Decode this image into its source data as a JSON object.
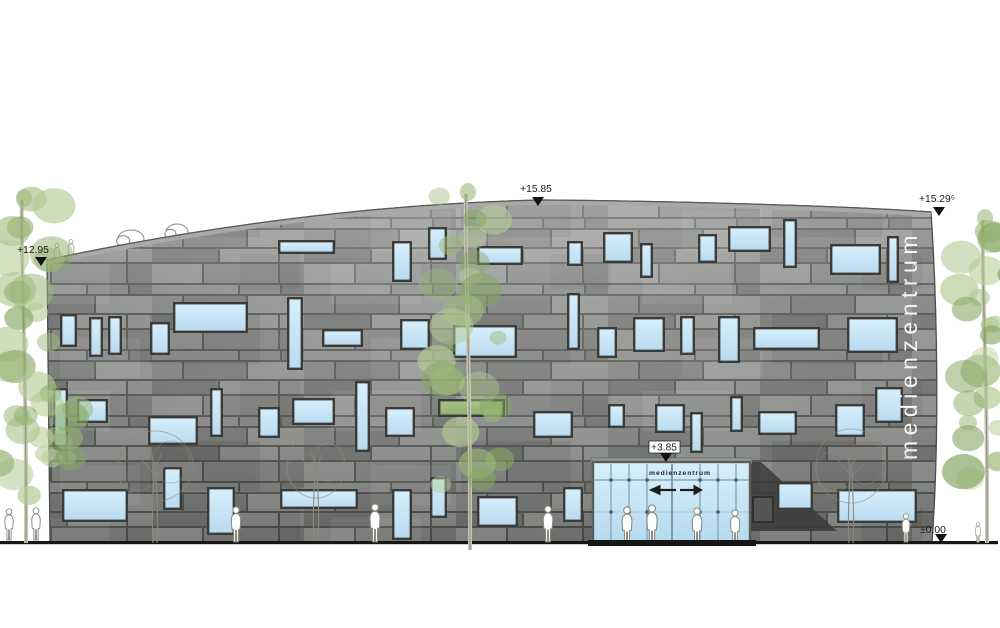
{
  "drawing": {
    "title_vertical": "medienzentrum",
    "markers": [
      {
        "label": "+15.85",
        "tx": 536,
        "ty": 192,
        "ax": 538,
        "ay": 206
      },
      {
        "label": "+15.29⁵",
        "tx": 937,
        "ty": 202,
        "ax": 939,
        "ay": 216
      },
      {
        "label": "+12.95",
        "tx": 33,
        "ty": 253,
        "ax": 41,
        "ay": 266
      },
      {
        "label": "+3.85",
        "tx": 664,
        "ty": 450.5,
        "ax": 666,
        "ay": 462,
        "box": [
          649,
          441,
          31,
          12
        ]
      },
      {
        "label": "±0.00",
        "tx": 933,
        "ty": 533,
        "ax": 941,
        "ay": 543
      }
    ],
    "entrance": {
      "x": 593,
      "y": 462,
      "w": 157,
      "h": 81,
      "sign": "medienzentrum",
      "mullions": [
        611,
        629,
        647,
        700,
        718,
        736
      ],
      "door_center": 672,
      "transom_y": 480,
      "dot_rows": [
        480,
        512
      ],
      "arrow_y": 490,
      "sign_x": 680,
      "sign_y": 475
    }
  },
  "colors": {
    "facade_joint": "#525351",
    "facade_blocks": [
      "#8d8f8d",
      "#7f817f",
      "#757775",
      "#888a88",
      "#6f716f"
    ],
    "parapet": "#a8aaa8",
    "outline": "#4c4d4b",
    "window_frame": "#3b3c3a",
    "window_blue_top": "#d6eefb",
    "window_blue_bottom": "#badcf0",
    "window_green": "#a6c186",
    "glass_top": "#d8effb",
    "glass_bottom": "#b5daee",
    "mullion": "#7b9dae",
    "dot": "#4e6473",
    "wedge": "#3a3b39",
    "ground": "#161614",
    "marker_text": "#1b1b19",
    "title_fill": "#f4f4f2",
    "tree_greens": [
      "#9cb97b",
      "#b4cb95",
      "#84a763"
    ],
    "trunk_light": "#cac7b9",
    "trunk_dark": "#8e8c7c",
    "sketch": "#888a80",
    "person_stroke": "#8b8b83"
  },
  "facade": {
    "outline": "M50,543 L47,260 C200,227 380,203 545,200 C700,201.5 852,206.5 931,212 C937.5,310 939.5,437 932,543 Z",
    "top_curve": "M47,260 C200,227 380,203 545,200 C700,201.5 852,206.5 931,212"
  },
  "windows": {
    "blue": [
      [
        278,
        240,
        57,
        14
      ],
      [
        392,
        241,
        20,
        41
      ],
      [
        428,
        227,
        19,
        33
      ],
      [
        477,
        246,
        46,
        19
      ],
      [
        567,
        241,
        16,
        25
      ],
      [
        603,
        232,
        30,
        31
      ],
      [
        640,
        243,
        13,
        35
      ],
      [
        698,
        234,
        19,
        29
      ],
      [
        728,
        226,
        43,
        26
      ],
      [
        783,
        219,
        14,
        49
      ],
      [
        830,
        244,
        51,
        31
      ],
      [
        887,
        236,
        12,
        47
      ],
      [
        60,
        314,
        17,
        33
      ],
      [
        89,
        317,
        14,
        40
      ],
      [
        108,
        316,
        14,
        39
      ],
      [
        150,
        322,
        20,
        33
      ],
      [
        173,
        302,
        75,
        31
      ],
      [
        287,
        297,
        16,
        73
      ],
      [
        322,
        329,
        41,
        18
      ],
      [
        400,
        319,
        30,
        31
      ],
      [
        453,
        325,
        64,
        33
      ],
      [
        567,
        293,
        13,
        57
      ],
      [
        597,
        327,
        20,
        31
      ],
      [
        633,
        317,
        32,
        35
      ],
      [
        680,
        316,
        15,
        39
      ],
      [
        718,
        316,
        22,
        47
      ],
      [
        753,
        327,
        67,
        23
      ],
      [
        847,
        317,
        51,
        36
      ],
      [
        53,
        388,
        15,
        59
      ],
      [
        77,
        399,
        31,
        24
      ],
      [
        148,
        416,
        50,
        29
      ],
      [
        210,
        388,
        13,
        49
      ],
      [
        258,
        407,
        22,
        31
      ],
      [
        292,
        398,
        43,
        27
      ],
      [
        355,
        381,
        15,
        71
      ],
      [
        385,
        407,
        30,
        30
      ],
      [
        533,
        411,
        40,
        27
      ],
      [
        608,
        404,
        17,
        24
      ],
      [
        655,
        404,
        30,
        29
      ],
      [
        690,
        412,
        13,
        41
      ],
      [
        730,
        396,
        13,
        36
      ],
      [
        758,
        411,
        39,
        24
      ],
      [
        835,
        404,
        30,
        33
      ],
      [
        875,
        387,
        28,
        36
      ],
      [
        62,
        489,
        66,
        33
      ],
      [
        163,
        467,
        19,
        43
      ],
      [
        207,
        487,
        28,
        48
      ],
      [
        280,
        489,
        78,
        20
      ],
      [
        392,
        489,
        20,
        51
      ],
      [
        430,
        477,
        17,
        41
      ],
      [
        477,
        496,
        41,
        31
      ],
      [
        563,
        487,
        20,
        35
      ],
      [
        777,
        482,
        36,
        28
      ],
      [
        837,
        489,
        80,
        34
      ]
    ],
    "green": [
      [
        438,
        399,
        67,
        18
      ]
    ]
  },
  "shadow_wedge": {
    "points": "750,462 761,462 837,531 750,531",
    "panel": [
      753,
      497,
      20,
      25
    ]
  },
  "ground_line": {
    "x1": 0,
    "x2": 998,
    "y": 541,
    "h": 3.2,
    "threshold": [
      588,
      540,
      168,
      6
    ]
  },
  "trees": {
    "green": [
      {
        "trunk_x": 24,
        "top": 188,
        "bottom": 543,
        "spread": 30,
        "blobs": 26,
        "seed": 7
      },
      {
        "trunk_x": 468,
        "top": 182,
        "bottom": 550,
        "spread": 33,
        "blobs": 24,
        "seed": 13
      },
      {
        "trunk_x": 985,
        "top": 208,
        "bottom": 543,
        "spread": 27,
        "blobs": 24,
        "seed": 29
      }
    ],
    "green_bush": {
      "cx": 58,
      "cy": 425,
      "spread": 20,
      "height": 80,
      "blobs": 9,
      "seed": 3
    },
    "sketch": [
      {
        "cx": 155,
        "crown_cy": 466,
        "rx": 38,
        "ry": 35,
        "ground": 543
      },
      {
        "cx": 316,
        "crown_cy": 466,
        "rx": 29,
        "ry": 32,
        "ground": 537
      },
      {
        "cx": 851,
        "crown_cy": 466,
        "rx": 35,
        "ry": 37,
        "ground": 543
      }
    ],
    "roof_bushes": [
      {
        "cx": 131,
        "cy": 239,
        "rx": 13,
        "ry": 9
      },
      {
        "cx": 177,
        "cy": 232,
        "rx": 11,
        "ry": 8
      }
    ]
  },
  "people": {
    "on_roof": [
      {
        "x": 57,
        "y": 266,
        "h": 23
      },
      {
        "x": 71,
        "y": 263,
        "h": 24
      }
    ],
    "on_ground": [
      {
        "x": 9,
        "y": 541,
        "h": 33
      },
      {
        "x": 36,
        "y": 541,
        "h": 34
      },
      {
        "x": 236,
        "y": 543,
        "h": 37
      },
      {
        "x": 375,
        "y": 543,
        "h": 40
      },
      {
        "x": 548,
        "y": 543,
        "h": 38
      },
      {
        "x": 906,
        "y": 543,
        "h": 30
      },
      {
        "x": 978,
        "y": 543,
        "h": 21
      }
    ],
    "in_entrance": [
      {
        "x": 627,
        "y": 545,
        "h": 39
      },
      {
        "x": 652,
        "y": 545,
        "h": 41
      },
      {
        "x": 697,
        "y": 545,
        "h": 38
      },
      {
        "x": 735,
        "y": 545,
        "h": 36
      }
    ]
  }
}
